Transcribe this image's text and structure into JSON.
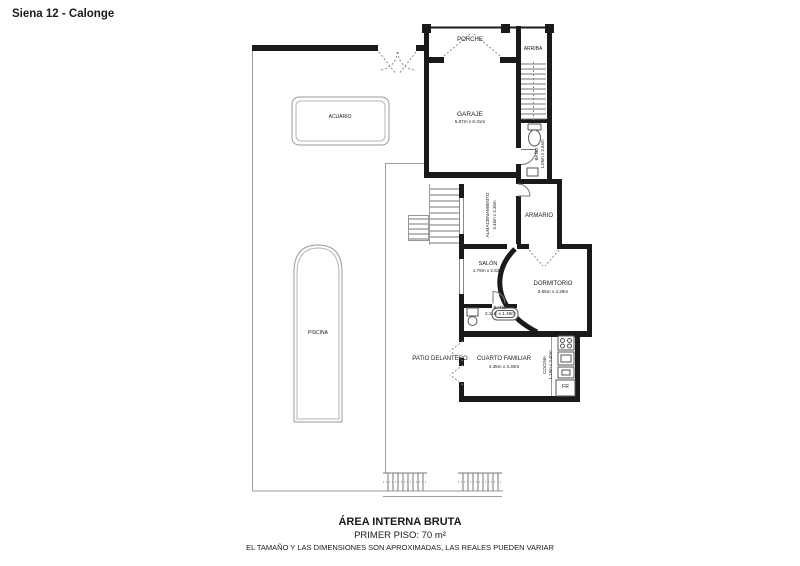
{
  "window_title": "Siena 12 - Calonge",
  "plan": {
    "rooms": {
      "porche": {
        "name": "PORCHE"
      },
      "arriba": {
        "name": "ARRIBA"
      },
      "garaje": {
        "name": "GARAJE",
        "dims": "5.87m x 6.31m"
      },
      "bano_garaje": {
        "name": "BAÑO",
        "dims": "1.05m x 2.54m"
      },
      "almacenamiento": {
        "name": "ALMACENAMIENTO",
        "dims": "2.46m x 3.35m"
      },
      "armario": {
        "name": "ARMARIO"
      },
      "salon": {
        "name": "SALÓN",
        "dims": "1.79m x 2.63m"
      },
      "dormitorio": {
        "name": "DORMITORIO",
        "dims": "3.55m x 4.29m"
      },
      "bano_salon": {
        "name": "BAÑO",
        "dims": "2.11m x 1.49m"
      },
      "cuarto_familiar": {
        "name": "CUARTO FAMILIAR",
        "dims": "4.35m x 3.40m"
      },
      "cocina": {
        "name": "COCINA",
        "dims": "1.19m x 3.40m"
      },
      "acuario": {
        "name": "ACUARIO"
      },
      "piscina": {
        "name": "PISCINA"
      },
      "patio_delantero": {
        "name": "PATIO DELANTERO"
      }
    },
    "appliances": {
      "fridge": "FR"
    },
    "colors": {
      "wall": "#1a1a1a",
      "thin_line": "#9e9e9e",
      "fixture": "#555555",
      "background": "#ffffff"
    }
  },
  "footer": {
    "line1": "ÁREA INTERNA BRUTA",
    "line2": "PRIMER PISO: 70 m²",
    "line3": "EL TAMAÑO Y LAS DIMENSIONES SON APROXIMADAS, LAS REALES PUEDEN VARIAR"
  }
}
